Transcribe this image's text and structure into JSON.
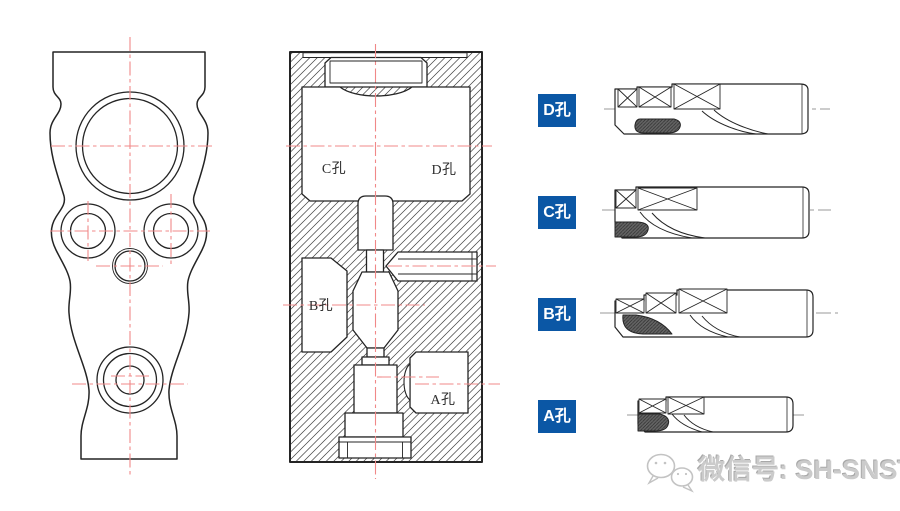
{
  "colors": {
    "drawing_line": "#242424",
    "centerline_red": "#f08888",
    "centerline_gray": "#9a9a9a",
    "hatch_line": "#3d3d3d",
    "tool_label_bg": "#0b57a5",
    "tool_label_text": "#ffffff",
    "chipbreaker_fill": "#5f5f5f",
    "watermark_text_color": "#cbcbcb"
  },
  "section_view": {
    "hole_labels": {
      "c": "C孔",
      "d": "D孔",
      "b": "B孔",
      "a": "A孔"
    }
  },
  "tools": [
    {
      "id": "tool-d",
      "label": "D孔"
    },
    {
      "id": "tool-c",
      "label": "C孔"
    },
    {
      "id": "tool-b",
      "label": "B孔"
    },
    {
      "id": "tool-a",
      "label": "A孔"
    }
  ],
  "watermark": {
    "icon": "wechat-icon",
    "text": "微信号: SH-SNSTC"
  }
}
